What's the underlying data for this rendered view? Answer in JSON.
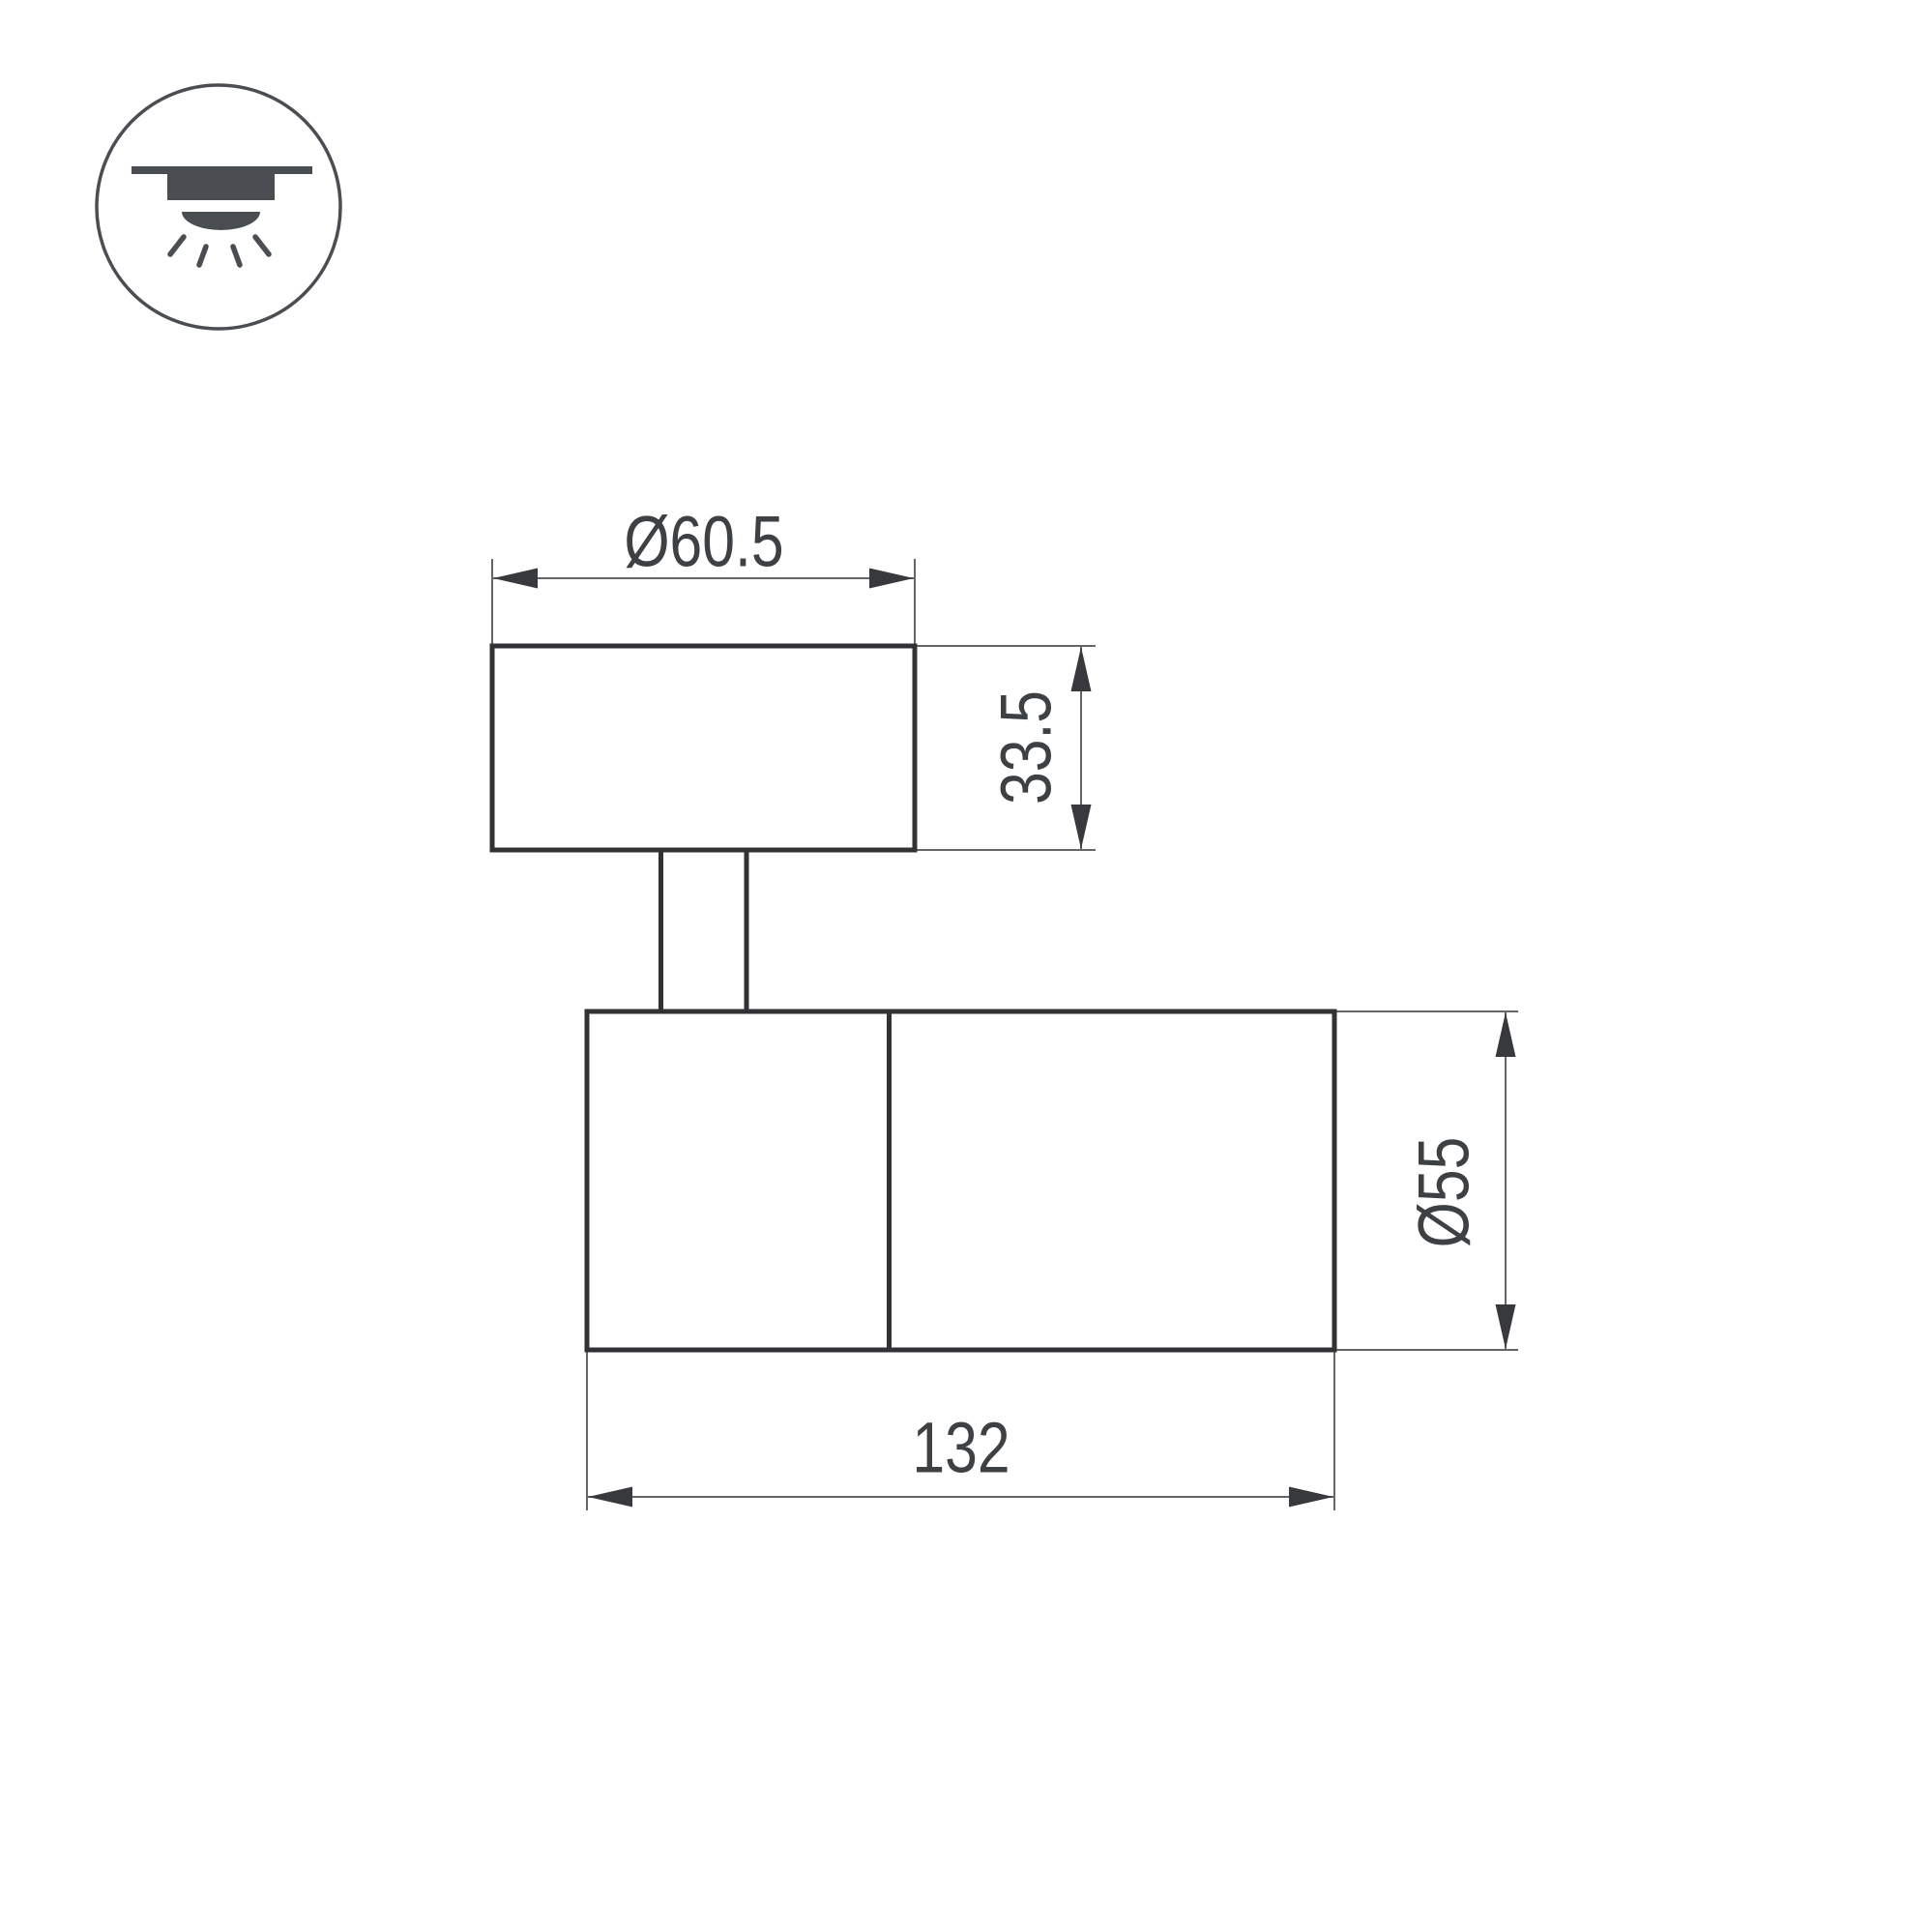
{
  "page": {
    "background": "#ffffff"
  },
  "icon": {
    "name": "surface-ceiling-mount-light-icon",
    "color": "#4a4e53"
  },
  "drawing": {
    "colors": {
      "outline": "#303234",
      "dimension_line": "#64676a",
      "arrowhead": "#37393c",
      "text": "#3e4144"
    },
    "dimensions": {
      "top_diameter": "Ø60.5",
      "base_height": "33.5",
      "body_diameter": "Ø55",
      "body_length": "132"
    }
  }
}
